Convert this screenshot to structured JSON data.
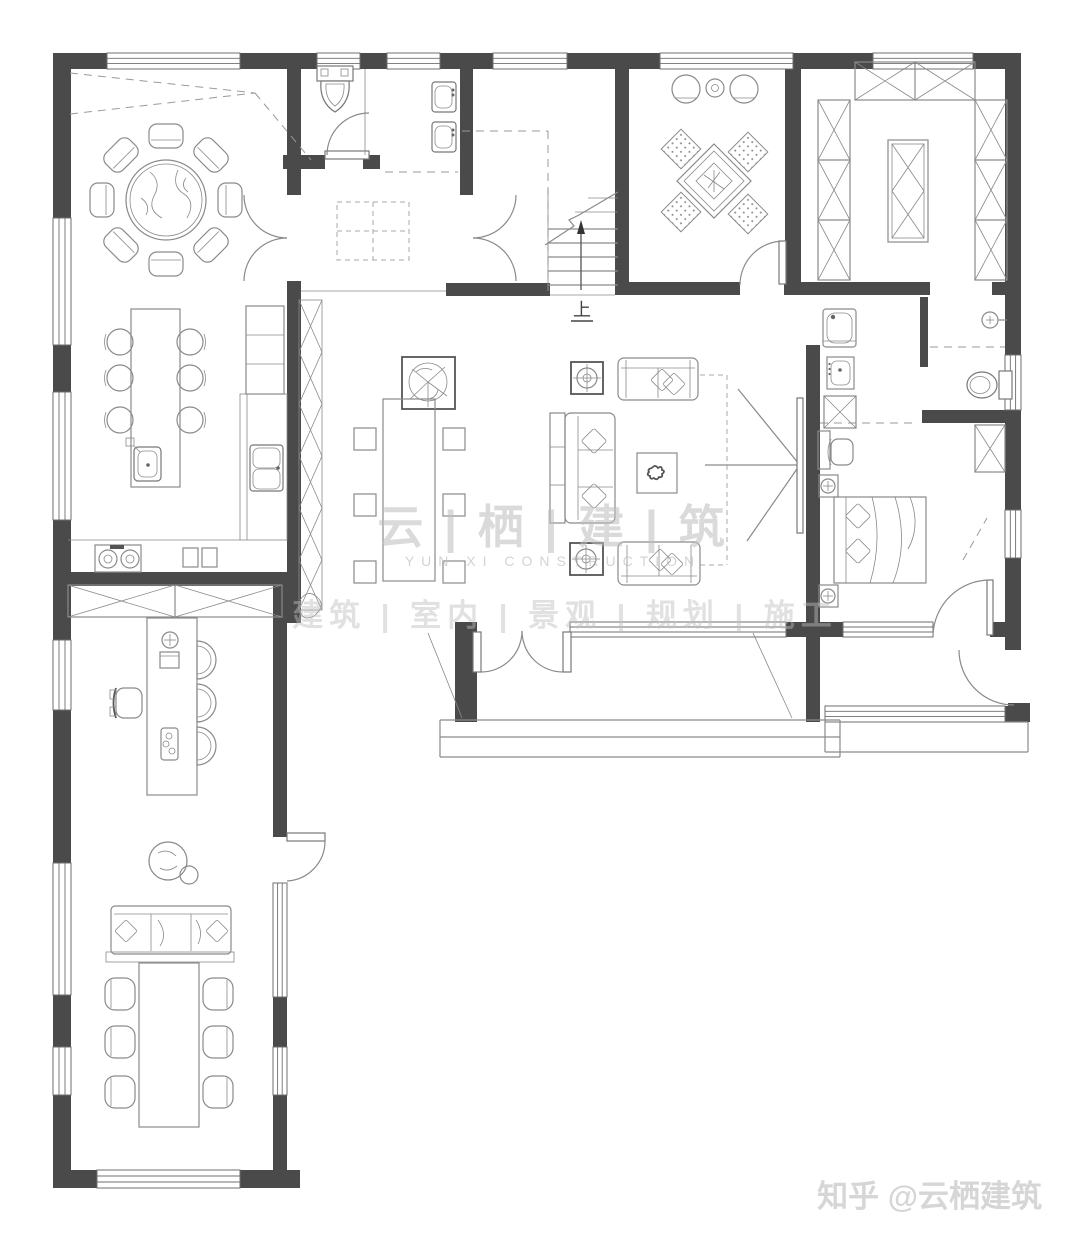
{
  "watermarks": {
    "brand_cn": "云 | 栖 | 建 | 筑",
    "brand_en": "YUN XI CONSTRUCTION",
    "services": "建筑 | 室内 | 景观 | 规划 | 施工",
    "credit": "知乎 @云栖建筑"
  },
  "annotations": {
    "stair_direction": "上"
  },
  "colors": {
    "wall": "#4a4a4a",
    "line": "#8a8a8a",
    "fixline": "#777777",
    "darkline": "#555555",
    "watermark": "#bdbdbd",
    "credit": "#d6d6d6",
    "background": "#ffffff",
    "text": "#444444"
  }
}
